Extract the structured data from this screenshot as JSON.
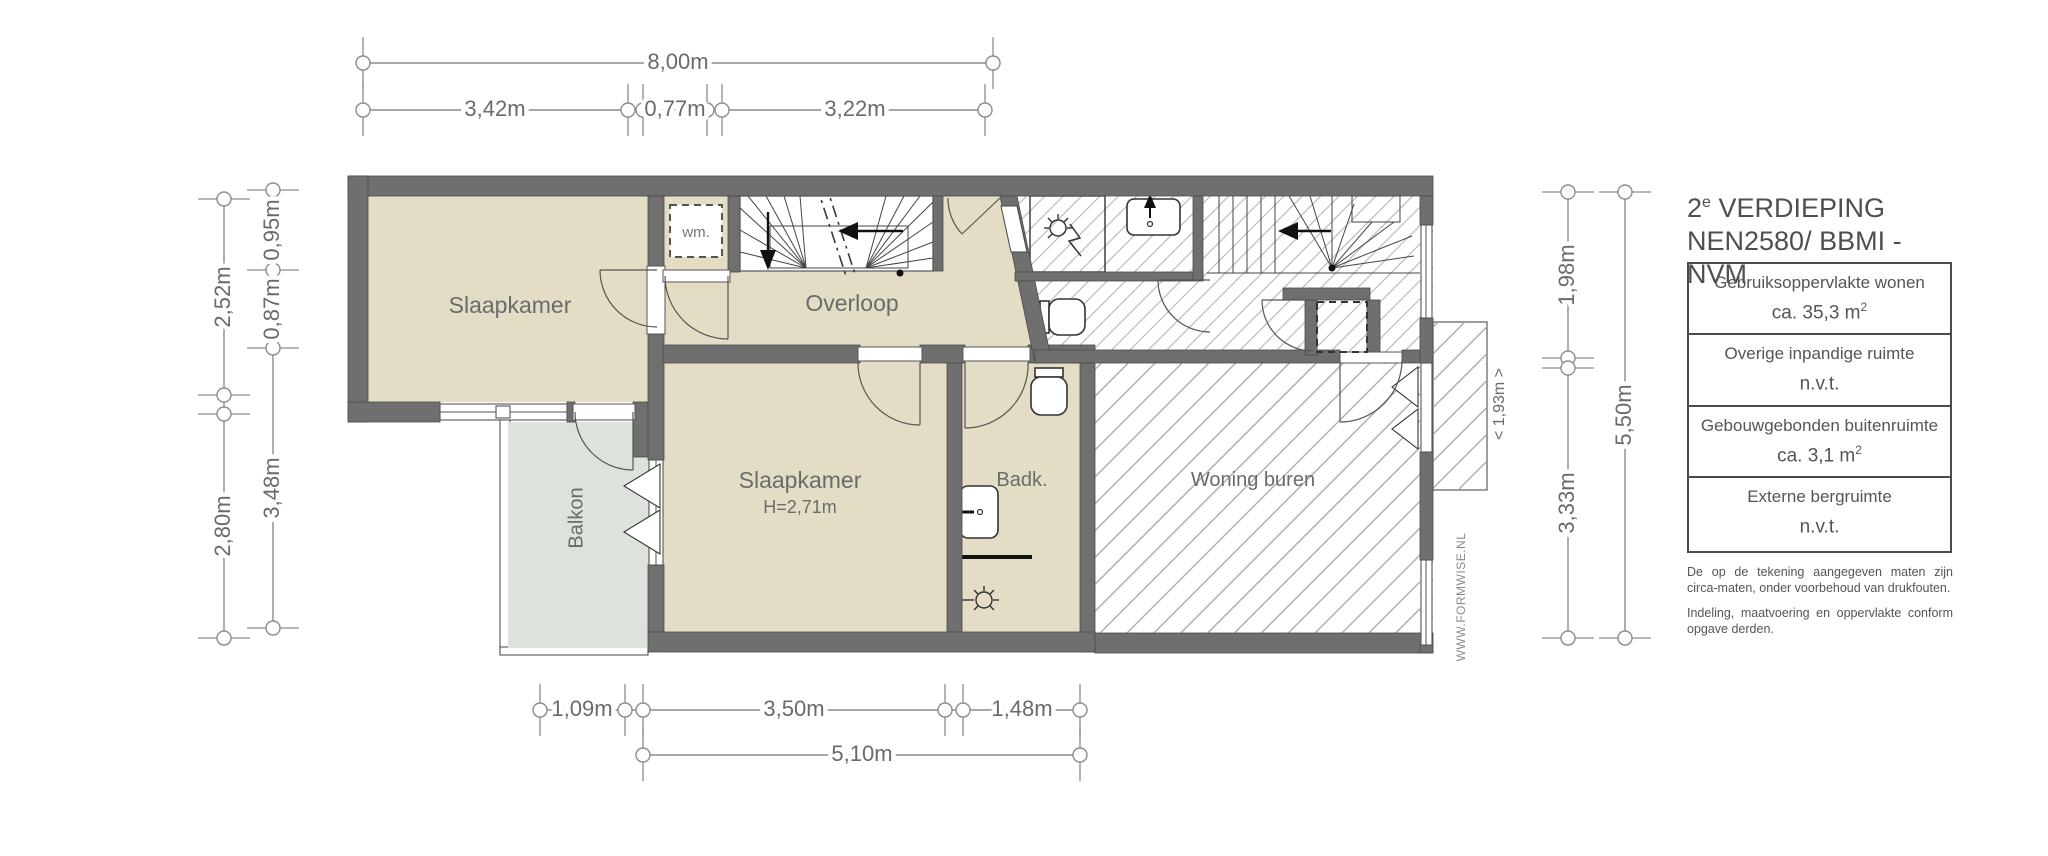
{
  "title": {
    "line1_num": "2",
    "line1_sup": "e",
    "line1_rest": " VERDIEPING",
    "line2": "NEN2580/ BBMI - NVM"
  },
  "legend": {
    "rows": [
      {
        "label": "Gebruiksoppervlakte wonen",
        "value": "ca. 35,3 m",
        "sup": "2"
      },
      {
        "label": "Overige inpandige ruimte",
        "value": "n.v.t.",
        "sup": ""
      },
      {
        "label": "Gebouwgebonden buitenruimte",
        "value": "ca. 3,1 m",
        "sup": "2"
      },
      {
        "label": "Externe bergruimte",
        "value": "n.v.t.",
        "sup": ""
      }
    ]
  },
  "disclaimer": {
    "p1": "De op de tekening aangegeven maten zijn circa-maten, onder voorbehoud van drukfouten.",
    "p2": "Indeling, maatvoering en oppervlakte conform opgave derden."
  },
  "watermark": "WWW.FORMWISE.NL",
  "rooms": {
    "bedroom1": "Slaapkamer",
    "washer": "wm.",
    "landing": "Overloop",
    "bedroom2": "Slaapkamer",
    "bedroom2_height": "H=2,71m",
    "bathroom": "Badk.",
    "balcony": "Balkon",
    "neighbor": "Woning buren",
    "neighbor_width": "< 1,93m >"
  },
  "dims": {
    "top_total": "8,00m",
    "top_1": "3,42m",
    "top_2": "0,77m",
    "top_3": "3,22m",
    "left_outer_1": "2,52m",
    "left_outer_2": "2,80m",
    "left_inner_1": "0,95m",
    "left_inner_2": "0,87m",
    "left_inner_3": "3,48m",
    "right_inner_1": "1,98m",
    "right_inner_2": "3,33m",
    "right_outer": "5,50m",
    "bottom_1": "1,09m",
    "bottom_2": "3,50m",
    "bottom_3": "1,48m",
    "bottom_total": "5,10m"
  },
  "colors": {
    "wall": "#6f6f6f",
    "room": "#e4ddc5",
    "balcony": "#dbe3da",
    "dim": "#8c8c8c"
  }
}
